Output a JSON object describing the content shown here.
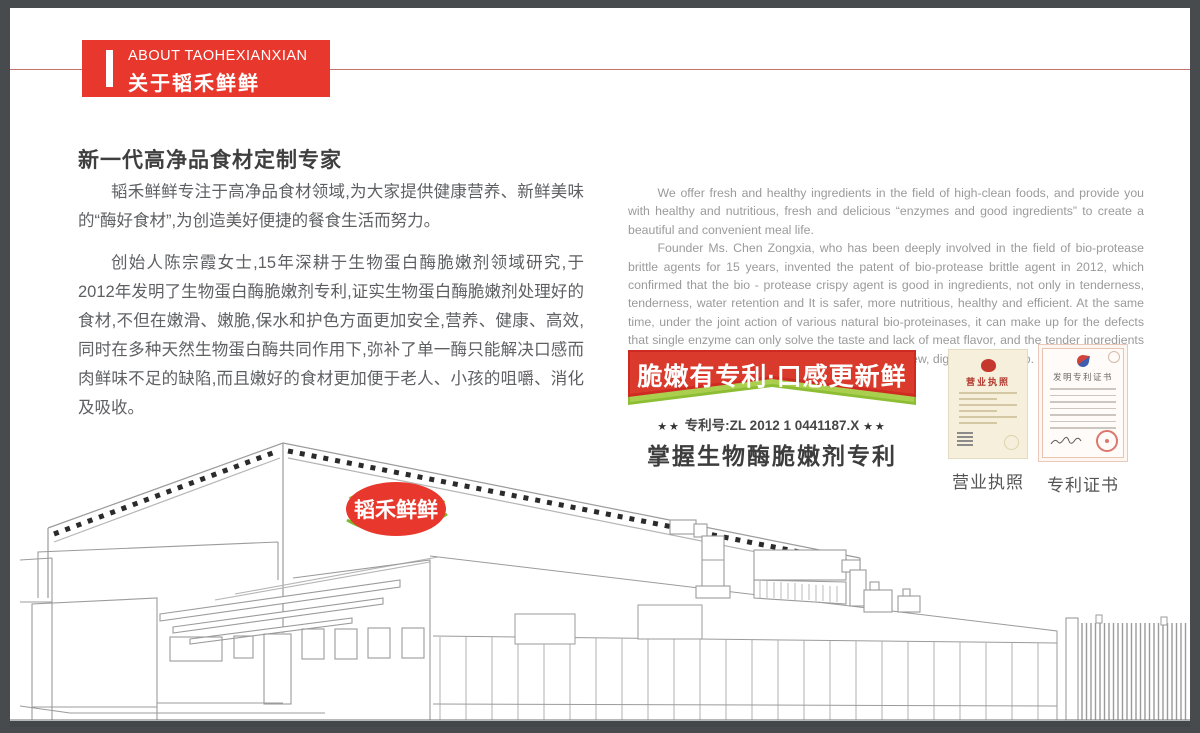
{
  "page": {
    "header": {
      "title_en": "ABOUT TAOHEXIANXIAN",
      "title_cn": "关于韬禾鲜鲜"
    },
    "intro": {
      "heading": "新一代高净品食材定制专家",
      "p1": "韬禾鲜鲜专注于高净品食材领域,为大家提供健康营养、新鲜美味的“酶好食材”,为创造美好便捷的餐食生活而努力。",
      "p2": "创始人陈宗霞女士,15年深耕于生物蛋白酶脆嫩剂领域研究,于2012年发明了生物蛋白酶脆嫩剂专利,证实生物蛋白酶脆嫩剂处理好的食材,不但在嫩滑、嫩脆,保水和护色方面更加安全,营养、健康、高效,同时在多种天然生物蛋白酶共同作用下,弥补了单一酶只能解决口感而肉鲜味不足的缺陷,而且嫩好的食材更加便于老人、小孩的咀嚼、消化及吸收。"
    },
    "english": {
      "p1": "We offer fresh and healthy ingredients in the field of high-clean foods, and provide you with healthy and nutritious, fresh and  delicious “enzymes and good ingredients” to create a beautiful and convenient meal life.",
      "p2": "Founder Ms. Chen Zongxia, who has been deeply involved in the field of bio-protease brittle agents for 15 years,  invented the patent of bio-protease brittle agent in 2012, which confirmed  that  the bio - protease crispy agent is good in ingredients, not only in tenderness, tenderness,  water retention and  It  is  safer,  more nutritious,  healthy  and  efficient.  At the same time,  under the joint action of various natural bio-proteinases, it can make up for the defects that single enzyme can only solve the taste and lack of meat flavor, and the tender ingredients are more convenient for the elderly and children. Chew, digest and absorb."
    },
    "patent": {
      "ribbon": "脆嫩有专利·口感更新鲜",
      "stars": "★★",
      "number_label": "专利号:ZL 2012 1 0441187.X",
      "subtitle": "掌握生物酶脆嫩剂专利"
    },
    "certificates": {
      "business": {
        "doc_title": "营业执照",
        "caption": "营业执照"
      },
      "patent_cert": {
        "doc_title": "发明专利证书",
        "caption": "专利证书"
      }
    },
    "factory": {
      "logo": "韬禾鲜鲜"
    },
    "colors": {
      "accent_red": "#e8382d",
      "ribbon_red": "#cf2a22",
      "ribbon_green": "#8cbd33",
      "frame_gray": "#474b4e"
    }
  }
}
